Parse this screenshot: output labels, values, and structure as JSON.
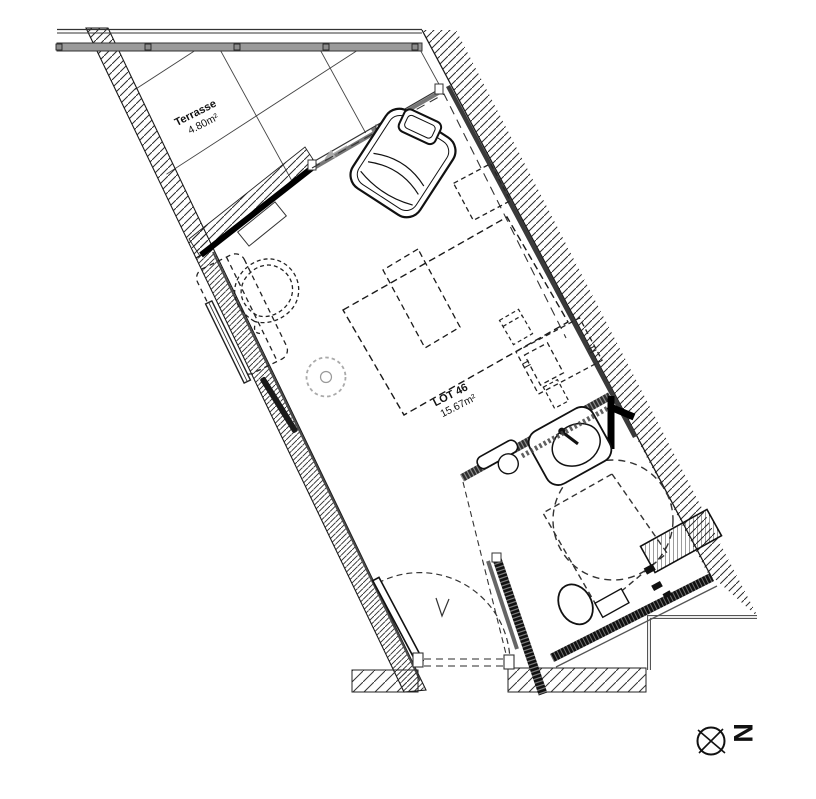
{
  "floor_plan": {
    "terrace": {
      "label": "Terrasse",
      "area": "4.80m²"
    },
    "lot": {
      "label": "LOT 46",
      "area": "15.67m²"
    },
    "compass": {
      "north": "N"
    },
    "colors": {
      "ink": "#1a1a1a",
      "wall_dark": "#2e2e2e",
      "railing_gray": "#9a9a9a",
      "light_gray": "#aaaaaa"
    }
  }
}
